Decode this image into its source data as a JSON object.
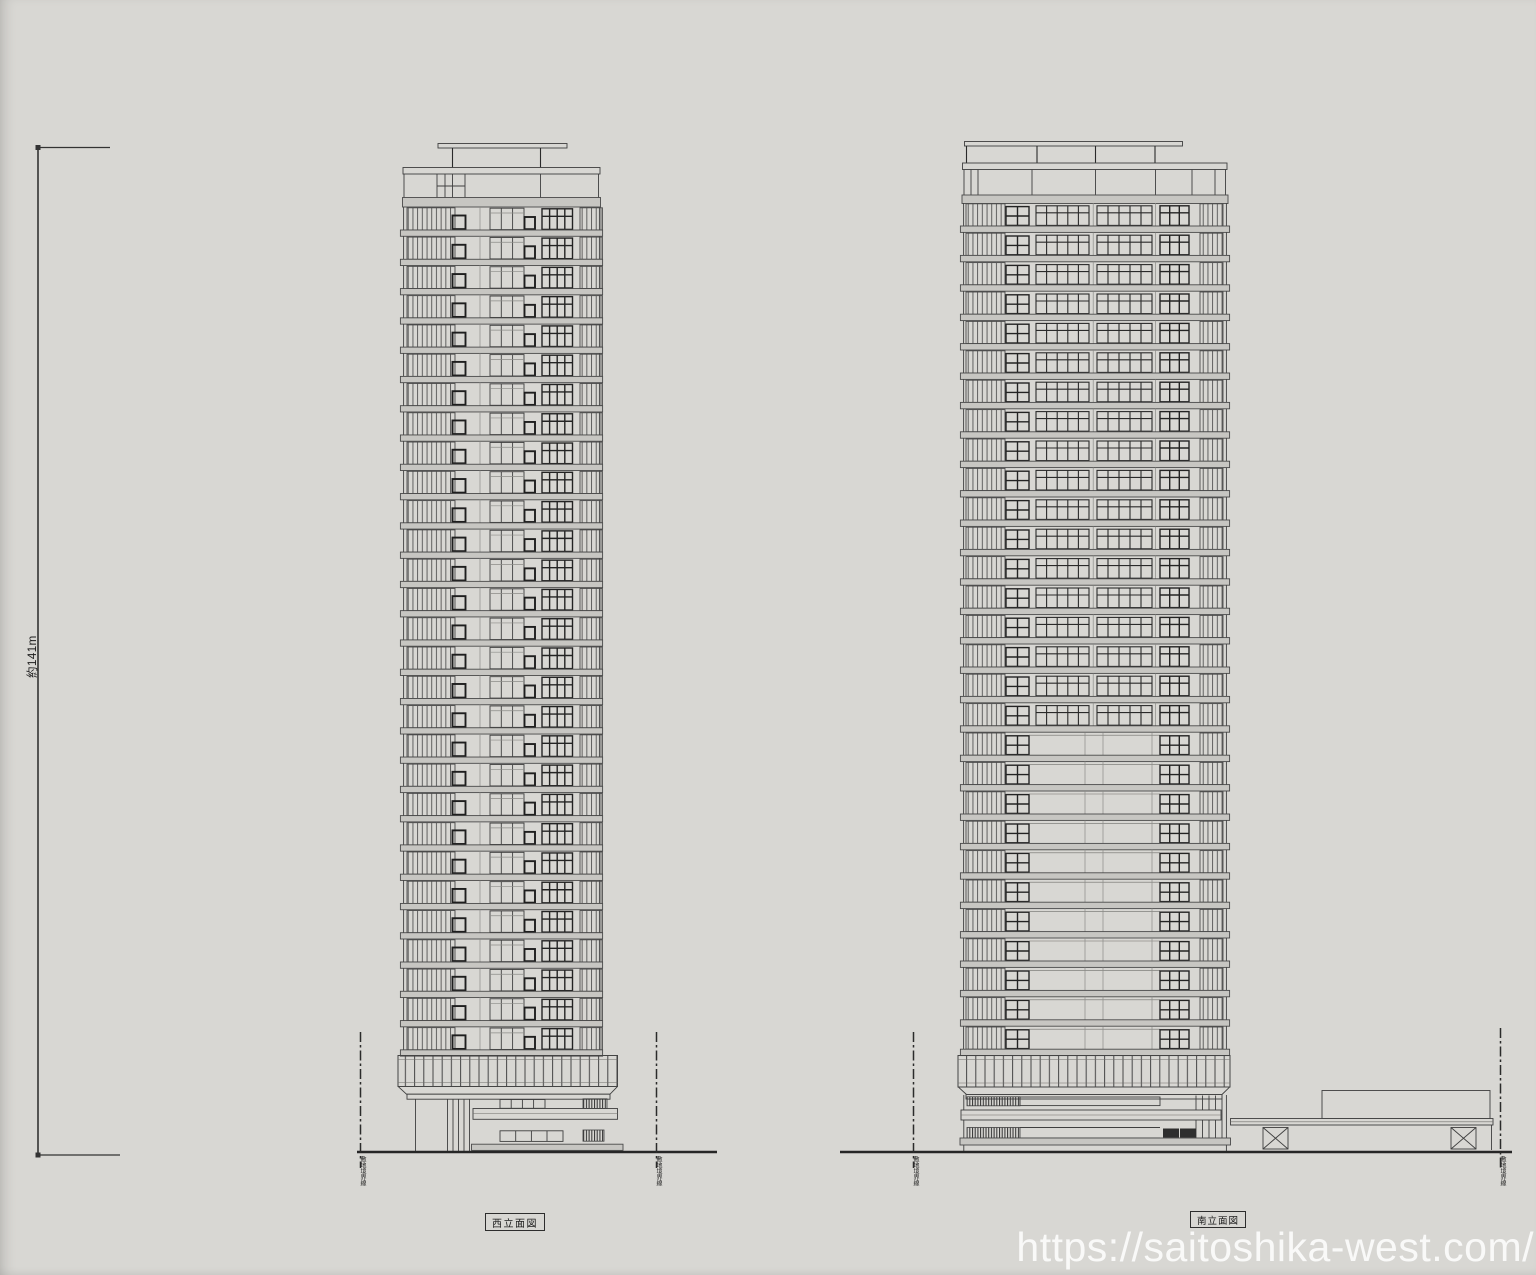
{
  "sheet": {
    "paper_color": "#d8d7d3",
    "ink_color": "#3f3f3f",
    "slab_color": "#c7c6c2",
    "watermark_text": "https://saitoshika-west.com/",
    "watermark_color": "#ffffff"
  },
  "height_dimension": {
    "label": "約141m"
  },
  "west_elevation": {
    "title": "西立面図",
    "floors": 29,
    "boundary_labels": [
      "敷地境界線",
      "敷地境界線"
    ]
  },
  "south_elevation": {
    "title": "南立面図",
    "floors": 29,
    "upper_pattern_floors": 18,
    "lower_pattern_floors": 11,
    "boundary_labels": [
      "敷地境界線",
      "敷地境界線"
    ]
  }
}
